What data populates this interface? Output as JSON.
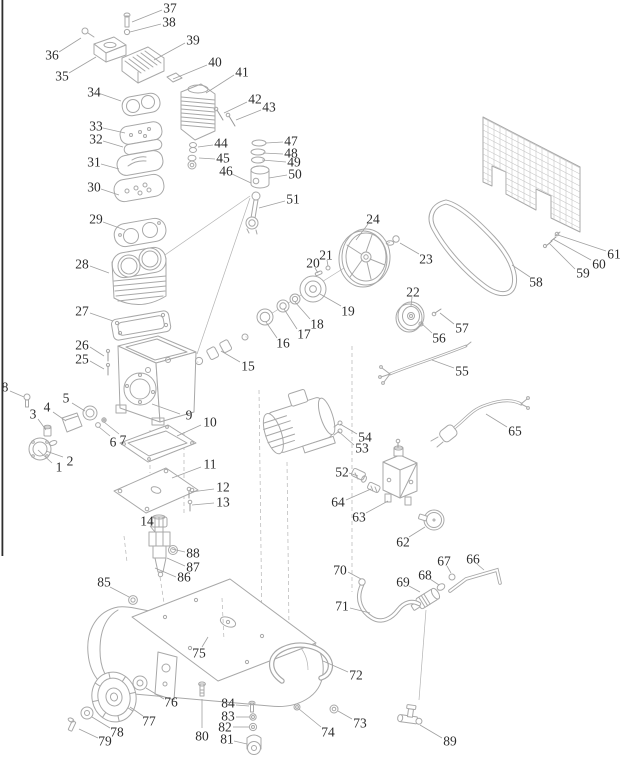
{
  "figure": {
    "type": "exploded-parts-diagram",
    "subject": "Air compressor exploded parts view",
    "part_count": 89,
    "colors": {
      "background": "#ffffff",
      "line": "#a8a8a8",
      "label": "#2d2d2d",
      "leader": "#a0a0a0",
      "edge_line": "#2e2e2e"
    },
    "labels": [
      {
        "n": "1",
        "x": 59,
        "y": 467,
        "lead": [
          52,
          463,
          38,
          450
        ]
      },
      {
        "n": "2",
        "x": 70,
        "y": 461,
        "lead": [
          63,
          457,
          46,
          451
        ]
      },
      {
        "n": "3",
        "x": 33,
        "y": 414,
        "lead": [
          38,
          419,
          46,
          430
        ]
      },
      {
        "n": "4",
        "x": 47,
        "y": 407,
        "lead": [
          53,
          412,
          66,
          421
        ]
      },
      {
        "n": "5",
        "x": 66,
        "y": 398,
        "lead": [
          72,
          403,
          85,
          411
        ]
      },
      {
        "n": "6",
        "x": 113,
        "y": 442,
        "lead": [
          110,
          436,
          99,
          427
        ]
      },
      {
        "n": "7",
        "x": 123,
        "y": 440,
        "lead": [
          119,
          434,
          104,
          422
        ]
      },
      {
        "n": "8",
        "x": 5,
        "y": 387,
        "lead": [
          10,
          391,
          24,
          397
        ]
      },
      {
        "n": "9",
        "x": 189,
        "y": 415,
        "lead": [
          180,
          414,
          152,
          404
        ]
      },
      {
        "n": "10",
        "x": 210,
        "y": 422,
        "lead": [
          201,
          425,
          177,
          436
        ]
      },
      {
        "n": "11",
        "x": 210,
        "y": 464,
        "lead": [
          201,
          467,
          172,
          478
        ]
      },
      {
        "n": "12",
        "x": 223,
        "y": 487,
        "lead": [
          214,
          489,
          191,
          492
        ]
      },
      {
        "n": "13",
        "x": 223,
        "y": 502,
        "lead": [
          214,
          503,
          192,
          505
        ]
      },
      {
        "n": "14",
        "x": 147,
        "y": 521,
        "lead": [
          150,
          526,
          155,
          532
        ]
      },
      {
        "n": "15",
        "x": 248,
        "y": 366,
        "lead": [
          240,
          362,
          221,
          351
        ]
      },
      {
        "n": "16",
        "x": 283,
        "y": 343,
        "lead": [
          277,
          338,
          266,
          322
        ]
      },
      {
        "n": "17",
        "x": 304,
        "y": 334,
        "lead": [
          297,
          329,
          284,
          309
        ]
      },
      {
        "n": "18",
        "x": 317,
        "y": 324,
        "lead": [
          310,
          319,
          295,
          302
        ]
      },
      {
        "n": "19",
        "x": 348,
        "y": 311,
        "lead": [
          341,
          306,
          320,
          294
        ]
      },
      {
        "n": "20",
        "x": 313,
        "y": 263,
        "lead": [
          315,
          268,
          318,
          273
        ]
      },
      {
        "n": "21",
        "x": 326,
        "y": 255,
        "lead": [
          327,
          260,
          328,
          266
        ]
      },
      {
        "n": "22",
        "x": 413,
        "y": 292,
        "lead": [
          412,
          297,
          411,
          306
        ]
      },
      {
        "n": "23",
        "x": 426,
        "y": 259,
        "lead": [
          419,
          254,
          400,
          243
        ]
      },
      {
        "n": "24",
        "x": 373,
        "y": 219,
        "lead": [
          368,
          224,
          356,
          240
        ]
      },
      {
        "n": "25",
        "x": 82,
        "y": 359,
        "lead": [
          90,
          361,
          104,
          369
        ]
      },
      {
        "n": "26",
        "x": 82,
        "y": 345,
        "lead": [
          90,
          347,
          104,
          356
        ]
      },
      {
        "n": "27",
        "x": 82,
        "y": 311,
        "lead": [
          90,
          313,
          113,
          321
        ]
      },
      {
        "n": "28",
        "x": 82,
        "y": 264,
        "lead": [
          90,
          266,
          109,
          273
        ]
      },
      {
        "n": "29",
        "x": 96,
        "y": 219,
        "lead": [
          103,
          222,
          125,
          230
        ]
      },
      {
        "n": "30",
        "x": 94,
        "y": 187,
        "lead": [
          101,
          189,
          119,
          195
        ]
      },
      {
        "n": "31",
        "x": 94,
        "y": 162,
        "lead": [
          101,
          164,
          119,
          169
        ]
      },
      {
        "n": "32",
        "x": 96,
        "y": 139,
        "lead": [
          103,
          141,
          123,
          147
        ]
      },
      {
        "n": "33",
        "x": 96,
        "y": 126,
        "lead": [
          103,
          128,
          125,
          133
        ]
      },
      {
        "n": "34",
        "x": 94,
        "y": 92,
        "lead": [
          101,
          94,
          121,
          101
        ]
      },
      {
        "n": "35",
        "x": 62,
        "y": 76,
        "lead": [
          69,
          73,
          96,
          57
        ]
      },
      {
        "n": "36",
        "x": 52,
        "y": 55,
        "lead": [
          59,
          52,
          81,
          38
        ]
      },
      {
        "n": "37",
        "x": 170,
        "y": 8,
        "lead": [
          162,
          10,
          132,
          22
        ]
      },
      {
        "n": "38",
        "x": 169,
        "y": 22,
        "lead": [
          161,
          24,
          130,
          32
        ]
      },
      {
        "n": "39",
        "x": 193,
        "y": 40,
        "lead": [
          185,
          43,
          154,
          60
        ]
      },
      {
        "n": "40",
        "x": 215,
        "y": 62,
        "lead": [
          207,
          65,
          173,
          79
        ]
      },
      {
        "n": "41",
        "x": 242,
        "y": 72,
        "lead": [
          234,
          75,
          206,
          93
        ]
      },
      {
        "n": "42",
        "x": 255,
        "y": 99,
        "lead": [
          247,
          102,
          224,
          113
        ]
      },
      {
        "n": "43",
        "x": 269,
        "y": 107,
        "lead": [
          261,
          110,
          236,
          120
        ]
      },
      {
        "n": "44",
        "x": 221,
        "y": 143,
        "lead": [
          213,
          145,
          198,
          147
        ]
      },
      {
        "n": "45",
        "x": 223,
        "y": 158,
        "lead": [
          215,
          159,
          199,
          158
        ]
      },
      {
        "n": "46",
        "x": 226,
        "y": 171,
        "lead": [
          232,
          174,
          251,
          183
        ]
      },
      {
        "n": "47",
        "x": 291,
        "y": 141,
        "lead": [
          283,
          142,
          266,
          143
        ]
      },
      {
        "n": "48",
        "x": 291,
        "y": 153,
        "lead": [
          283,
          154,
          263,
          153
        ]
      },
      {
        "n": "49",
        "x": 294,
        "y": 162,
        "lead": [
          286,
          162,
          262,
          160
        ]
      },
      {
        "n": "50",
        "x": 295,
        "y": 174,
        "lead": [
          287,
          175,
          269,
          178
        ]
      },
      {
        "n": "51",
        "x": 293,
        "y": 199,
        "lead": [
          285,
          201,
          259,
          208
        ]
      },
      {
        "n": "52",
        "x": 342,
        "y": 472,
        "lead": [
          349,
          473,
          358,
          476
        ]
      },
      {
        "n": "53",
        "x": 362,
        "y": 448,
        "lead": [
          354,
          445,
          338,
          431
        ]
      },
      {
        "n": "54",
        "x": 365,
        "y": 437,
        "lead": [
          357,
          434,
          340,
          424
        ]
      },
      {
        "n": "55",
        "x": 462,
        "y": 371,
        "lead": [
          454,
          368,
          432,
          360
        ]
      },
      {
        "n": "56",
        "x": 439,
        "y": 338,
        "lead": [
          432,
          333,
          421,
          323
        ]
      },
      {
        "n": "57",
        "x": 462,
        "y": 328,
        "lead": [
          454,
          324,
          440,
          313
        ]
      },
      {
        "n": "58",
        "x": 536,
        "y": 282,
        "lead": [
          530,
          277,
          512,
          265
        ]
      },
      {
        "n": "59",
        "x": 583,
        "y": 273,
        "lead": [
          575,
          269,
          549,
          243
        ]
      },
      {
        "n": "60",
        "x": 599,
        "y": 264,
        "lead": [
          591,
          260,
          553,
          239
        ]
      },
      {
        "n": "61",
        "x": 614,
        "y": 254,
        "lead": [
          606,
          251,
          558,
          235
        ]
      },
      {
        "n": "62",
        "x": 403,
        "y": 542,
        "lead": [
          409,
          537,
          425,
          527
        ]
      },
      {
        "n": "63",
        "x": 359,
        "y": 517,
        "lead": [
          366,
          513,
          388,
          501
        ]
      },
      {
        "n": "64",
        "x": 338,
        "y": 502,
        "lead": [
          346,
          500,
          371,
          489
        ]
      },
      {
        "n": "65",
        "x": 515,
        "y": 431,
        "lead": [
          507,
          427,
          486,
          414
        ]
      },
      {
        "n": "66",
        "x": 473,
        "y": 559,
        "lead": [
          477,
          564,
          484,
          570
        ]
      },
      {
        "n": "67",
        "x": 444,
        "y": 561,
        "lead": [
          447,
          566,
          451,
          573
        ]
      },
      {
        "n": "68",
        "x": 425,
        "y": 575,
        "lead": [
          430,
          579,
          439,
          585
        ]
      },
      {
        "n": "69",
        "x": 403,
        "y": 582,
        "lead": [
          409,
          586,
          420,
          592
        ]
      },
      {
        "n": "70",
        "x": 340,
        "y": 570,
        "lead": [
          348,
          572,
          361,
          579
        ]
      },
      {
        "n": "71",
        "x": 342,
        "y": 606,
        "lead": [
          350,
          608,
          370,
          613
        ]
      },
      {
        "n": "72",
        "x": 356,
        "y": 675,
        "lead": [
          348,
          672,
          323,
          661
        ]
      },
      {
        "n": "73",
        "x": 360,
        "y": 723,
        "lead": [
          352,
          719,
          338,
          711
        ]
      },
      {
        "n": "74",
        "x": 328,
        "y": 732,
        "lead": [
          321,
          727,
          299,
          709
        ]
      },
      {
        "n": "75",
        "x": 199,
        "y": 653,
        "lead": [
          202,
          647,
          208,
          637
        ]
      },
      {
        "n": "76",
        "x": 171,
        "y": 702,
        "lead": [
          164,
          699,
          146,
          688
        ]
      },
      {
        "n": "77",
        "x": 149,
        "y": 721,
        "lead": [
          143,
          716,
          130,
          707
        ]
      },
      {
        "n": "78",
        "x": 117,
        "y": 732,
        "lead": [
          110,
          728,
          92,
          717
        ]
      },
      {
        "n": "79",
        "x": 105,
        "y": 741,
        "lead": [
          98,
          738,
          79,
          729
        ]
      },
      {
        "n": "80",
        "x": 202,
        "y": 736,
        "lead": [
          202,
          728,
          202,
          699
        ]
      },
      {
        "n": "81",
        "x": 227,
        "y": 739,
        "lead": [
          234,
          741,
          247,
          744
        ]
      },
      {
        "n": "82",
        "x": 225,
        "y": 727,
        "lead": [
          233,
          727,
          249,
          727
        ]
      },
      {
        "n": "83",
        "x": 228,
        "y": 716,
        "lead": [
          236,
          717,
          250,
          717
        ]
      },
      {
        "n": "84",
        "x": 228,
        "y": 703,
        "lead": [
          236,
          705,
          249,
          706
        ]
      },
      {
        "n": "85",
        "x": 104,
        "y": 582,
        "lead": [
          110,
          587,
          129,
          597
        ]
      },
      {
        "n": "86",
        "x": 184,
        "y": 577,
        "lead": [
          176,
          577,
          155,
          568
        ]
      },
      {
        "n": "87",
        "x": 193,
        "y": 567,
        "lead": [
          185,
          566,
          167,
          558
        ]
      },
      {
        "n": "88",
        "x": 193,
        "y": 553,
        "lead": [
          185,
          552,
          172,
          549
        ]
      },
      {
        "n": "89",
        "x": 450,
        "y": 741,
        "lead": [
          442,
          738,
          420,
          725
        ]
      }
    ]
  }
}
